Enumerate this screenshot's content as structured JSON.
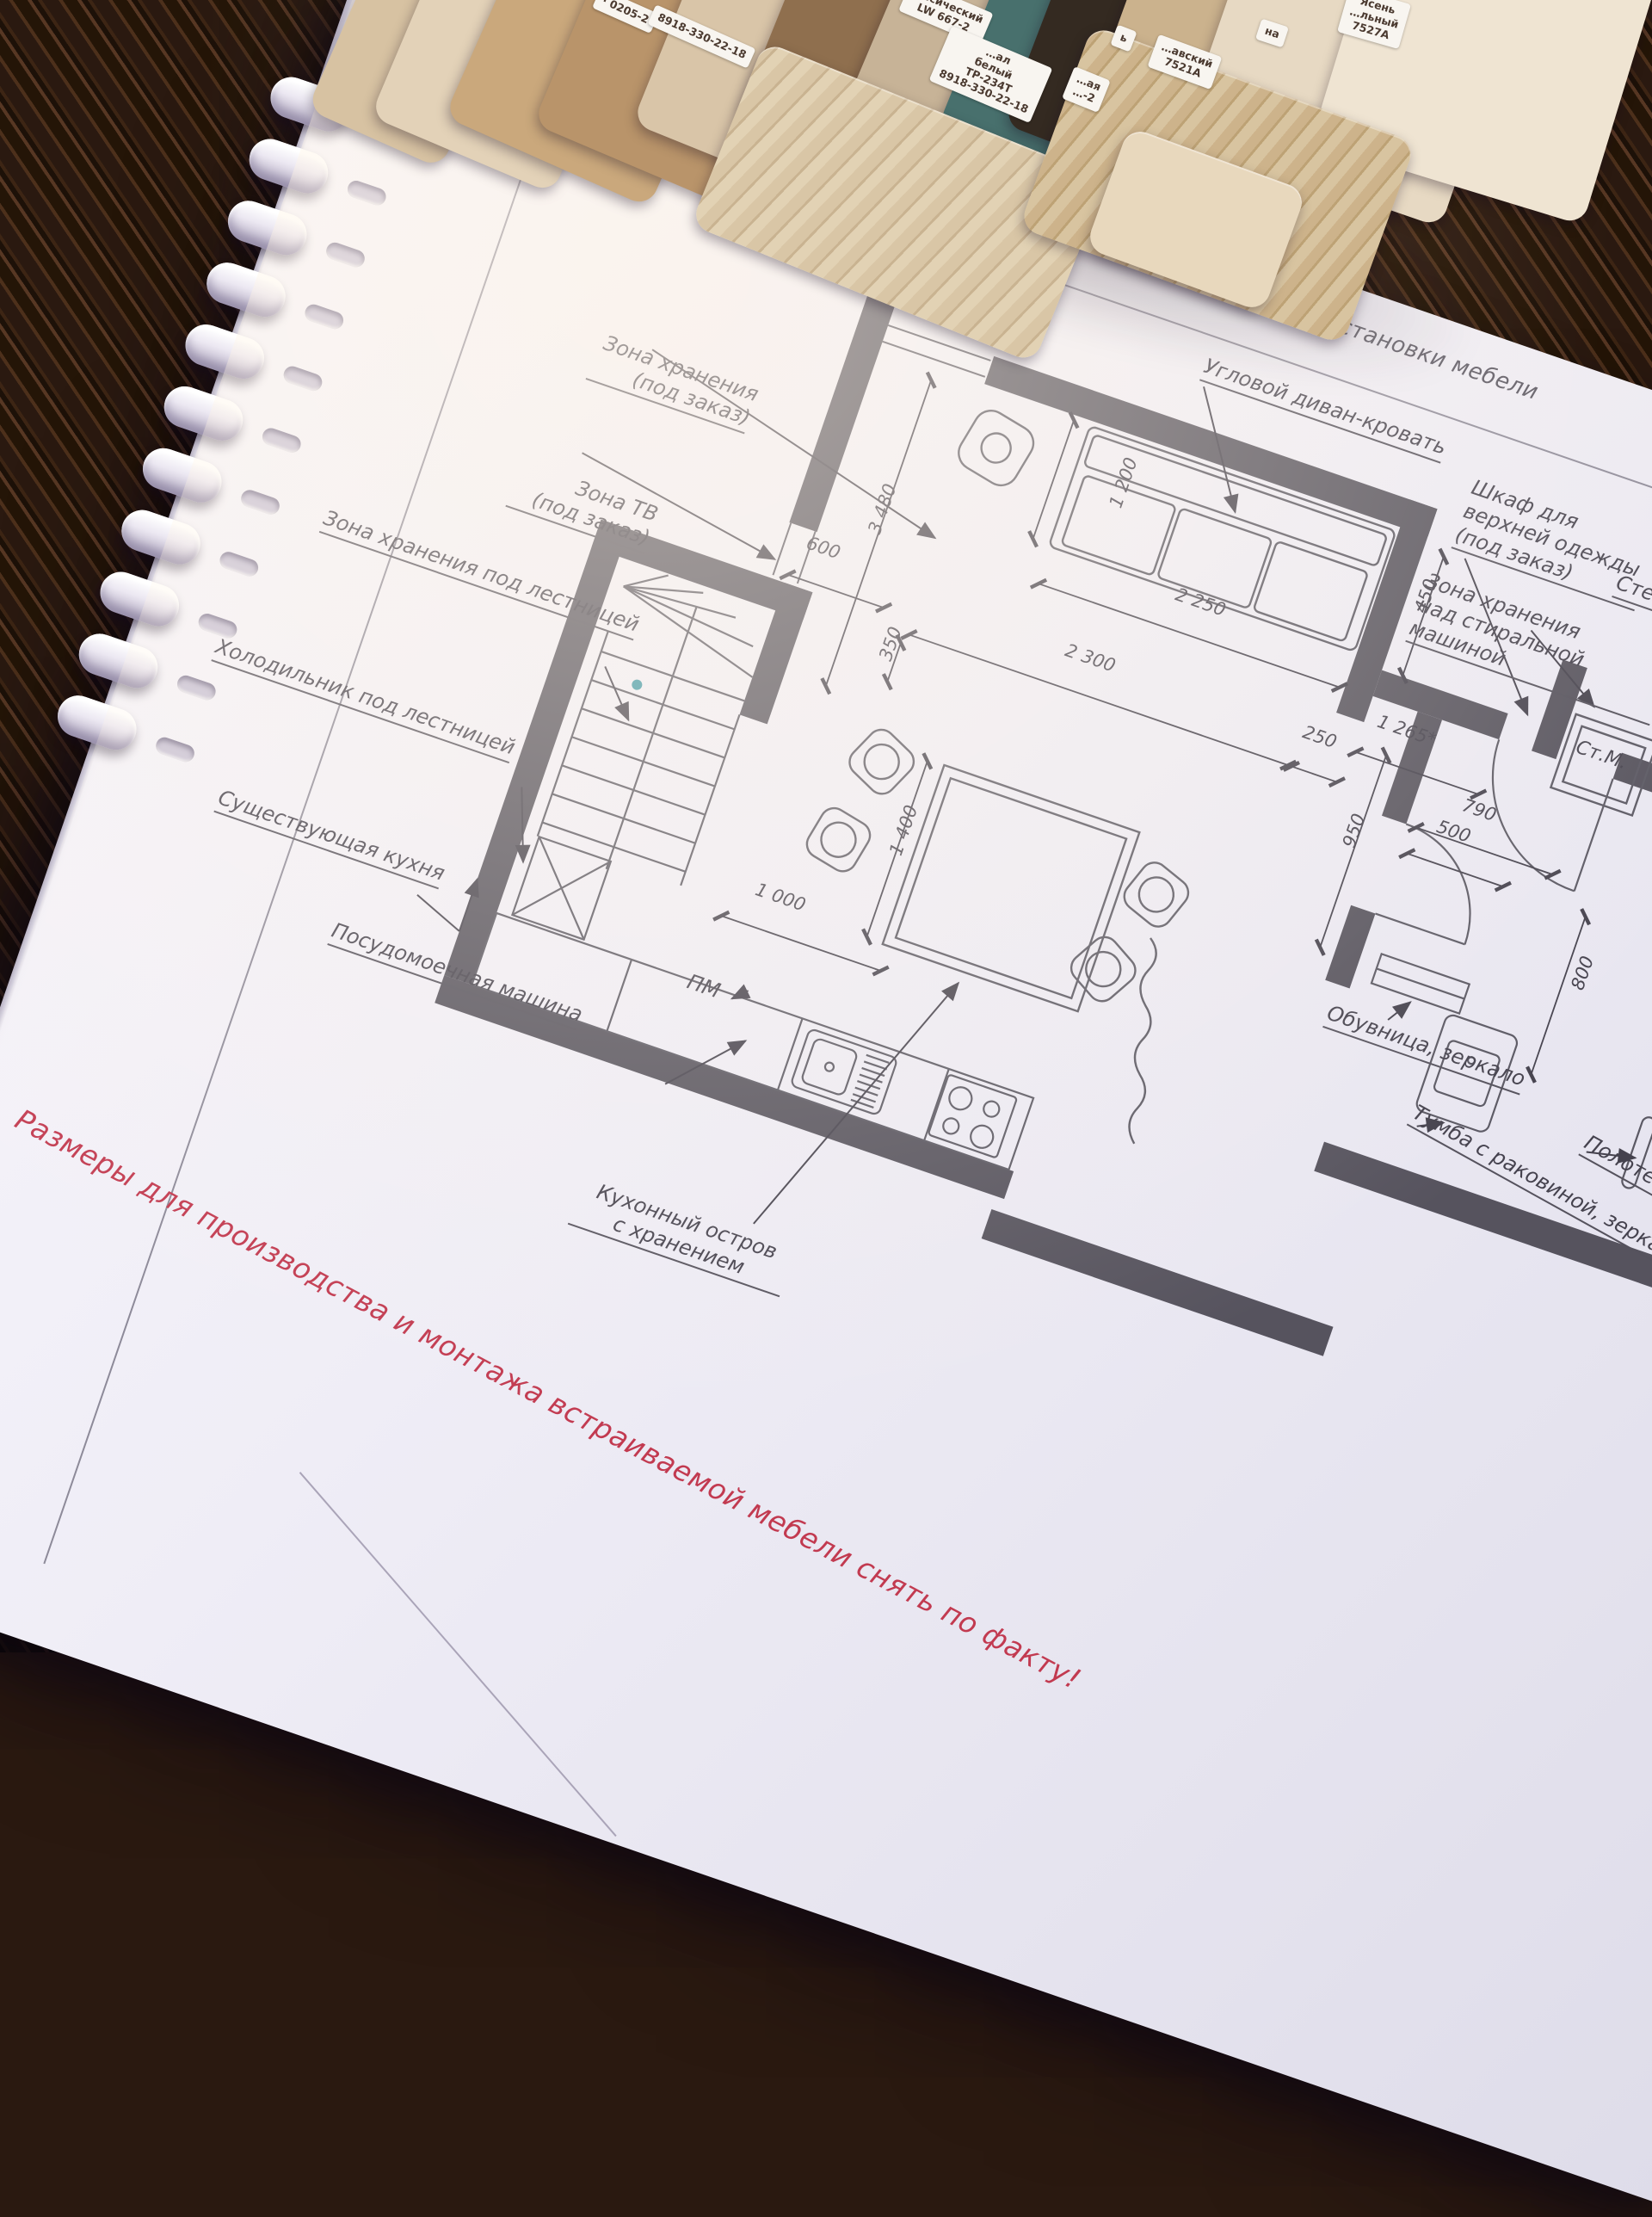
{
  "colors": {
    "paper": "#efedf6",
    "wall": "#56535e",
    "ink": "#45424e",
    "red_note": "#c23a50",
    "wood": "#3a2514",
    "teal_dot": "#3e98a6"
  },
  "samples": {
    "cards": [
      {
        "text": "· 0205-2"
      },
      {
        "text": "8918-330-22-18"
      },
      {
        "text": "…ссический\nLW 667-2"
      },
      {
        "text": "…ал\nбелый\nТР-234Т\n8918-330-22-18"
      },
      {
        "text": "…ая\n…-2"
      },
      {
        "text": "ь"
      },
      {
        "text": "…авский\n7521А"
      },
      {
        "text": "на"
      },
      {
        "text": "Ясень\n…льный\n7527А"
      }
    ]
  },
  "plan": {
    "title": "План расстановки мебели",
    "red_note": "Размеры для производства и монтажа встраиваемой мебели снять по факту!",
    "labels": {
      "storage_zone": "Зона хранения\n(под заказ)",
      "tv_zone": "Зона ТВ\n(под заказ)",
      "under_stairs": "Зона хранения под лестницей",
      "fridge": "Холодильник под лестницей",
      "existing_kitchen": "Существующая кухня",
      "dishwasher": "Посудомоечная машина",
      "island": "Кухонный остров\nс хранением",
      "pm": "ПМ",
      "sofa": "Угловой диван-кровать",
      "wardrobe": "Шкаф для\nверхней одежды\n(под заказ)",
      "washer_storage": "Зона хранения\nнад стиральной машиной",
      "washer": "Ст.М.",
      "shoe_cabinet": "Обувница, зеркало",
      "vanity": "Тумба с раковиной, зеркало",
      "towel": "Полотенцесушитель",
      "shelf_fragment": "Сте"
    },
    "dimensions": {
      "sofa_depth": "1 200",
      "sofa_width": "2 250",
      "room_height": "3 480",
      "tv_niche": "600",
      "gap": "350",
      "room_width": "2 300",
      "offset": "250",
      "entry": "1 265*",
      "niche_step": "450",
      "washer_niche": "790",
      "washer_width": "500",
      "bath_depth": "800",
      "hall_depth": "950",
      "island_length": "1 400",
      "aisle": "1 000"
    }
  }
}
